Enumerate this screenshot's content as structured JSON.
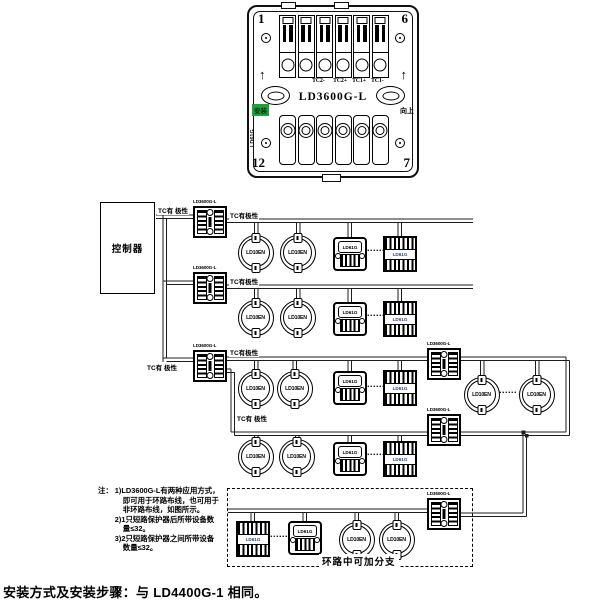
{
  "device_panel": {
    "model": "LD3600G-L",
    "corner_numbers": {
      "top_left": "1",
      "top_right": "6",
      "bottom_left": "12",
      "bottom_right": "7"
    },
    "terminal_labels": [
      "TC2-",
      "TC2+",
      "TC1+",
      "TC1-"
    ],
    "install_label": "安装",
    "up_label": "向上",
    "side_label": "LD61G",
    "up_arrow": "↑"
  },
  "diagram": {
    "controller_label": "控制器",
    "module_label": "LD3600G-L",
    "detector_label": "LD10EN",
    "sp_label": "LD61G",
    "polarity_a": "TC有 极性",
    "polarity_b": "TC有极性",
    "branch_label": "环路中可加分支",
    "dots": "......"
  },
  "colors": {
    "install_badge_green": "#1fa03c",
    "striped_module_label_blue": "#2b3f8f",
    "line_black": "#1c1c1c"
  },
  "notes": {
    "prefix": "注：",
    "lines": [
      "1)LD3600G-L有两种应用方式，",
      "即可用于环路布线，也可用于",
      "非环路布线，如图所示。",
      "2)1只短路保护器后所带设备数",
      "量≤32。",
      "3)2只短路保护器之间所带设备",
      "数量≤32。"
    ]
  },
  "caption": "安装方式及安装步骤：与 LD4400G-1 相同。"
}
